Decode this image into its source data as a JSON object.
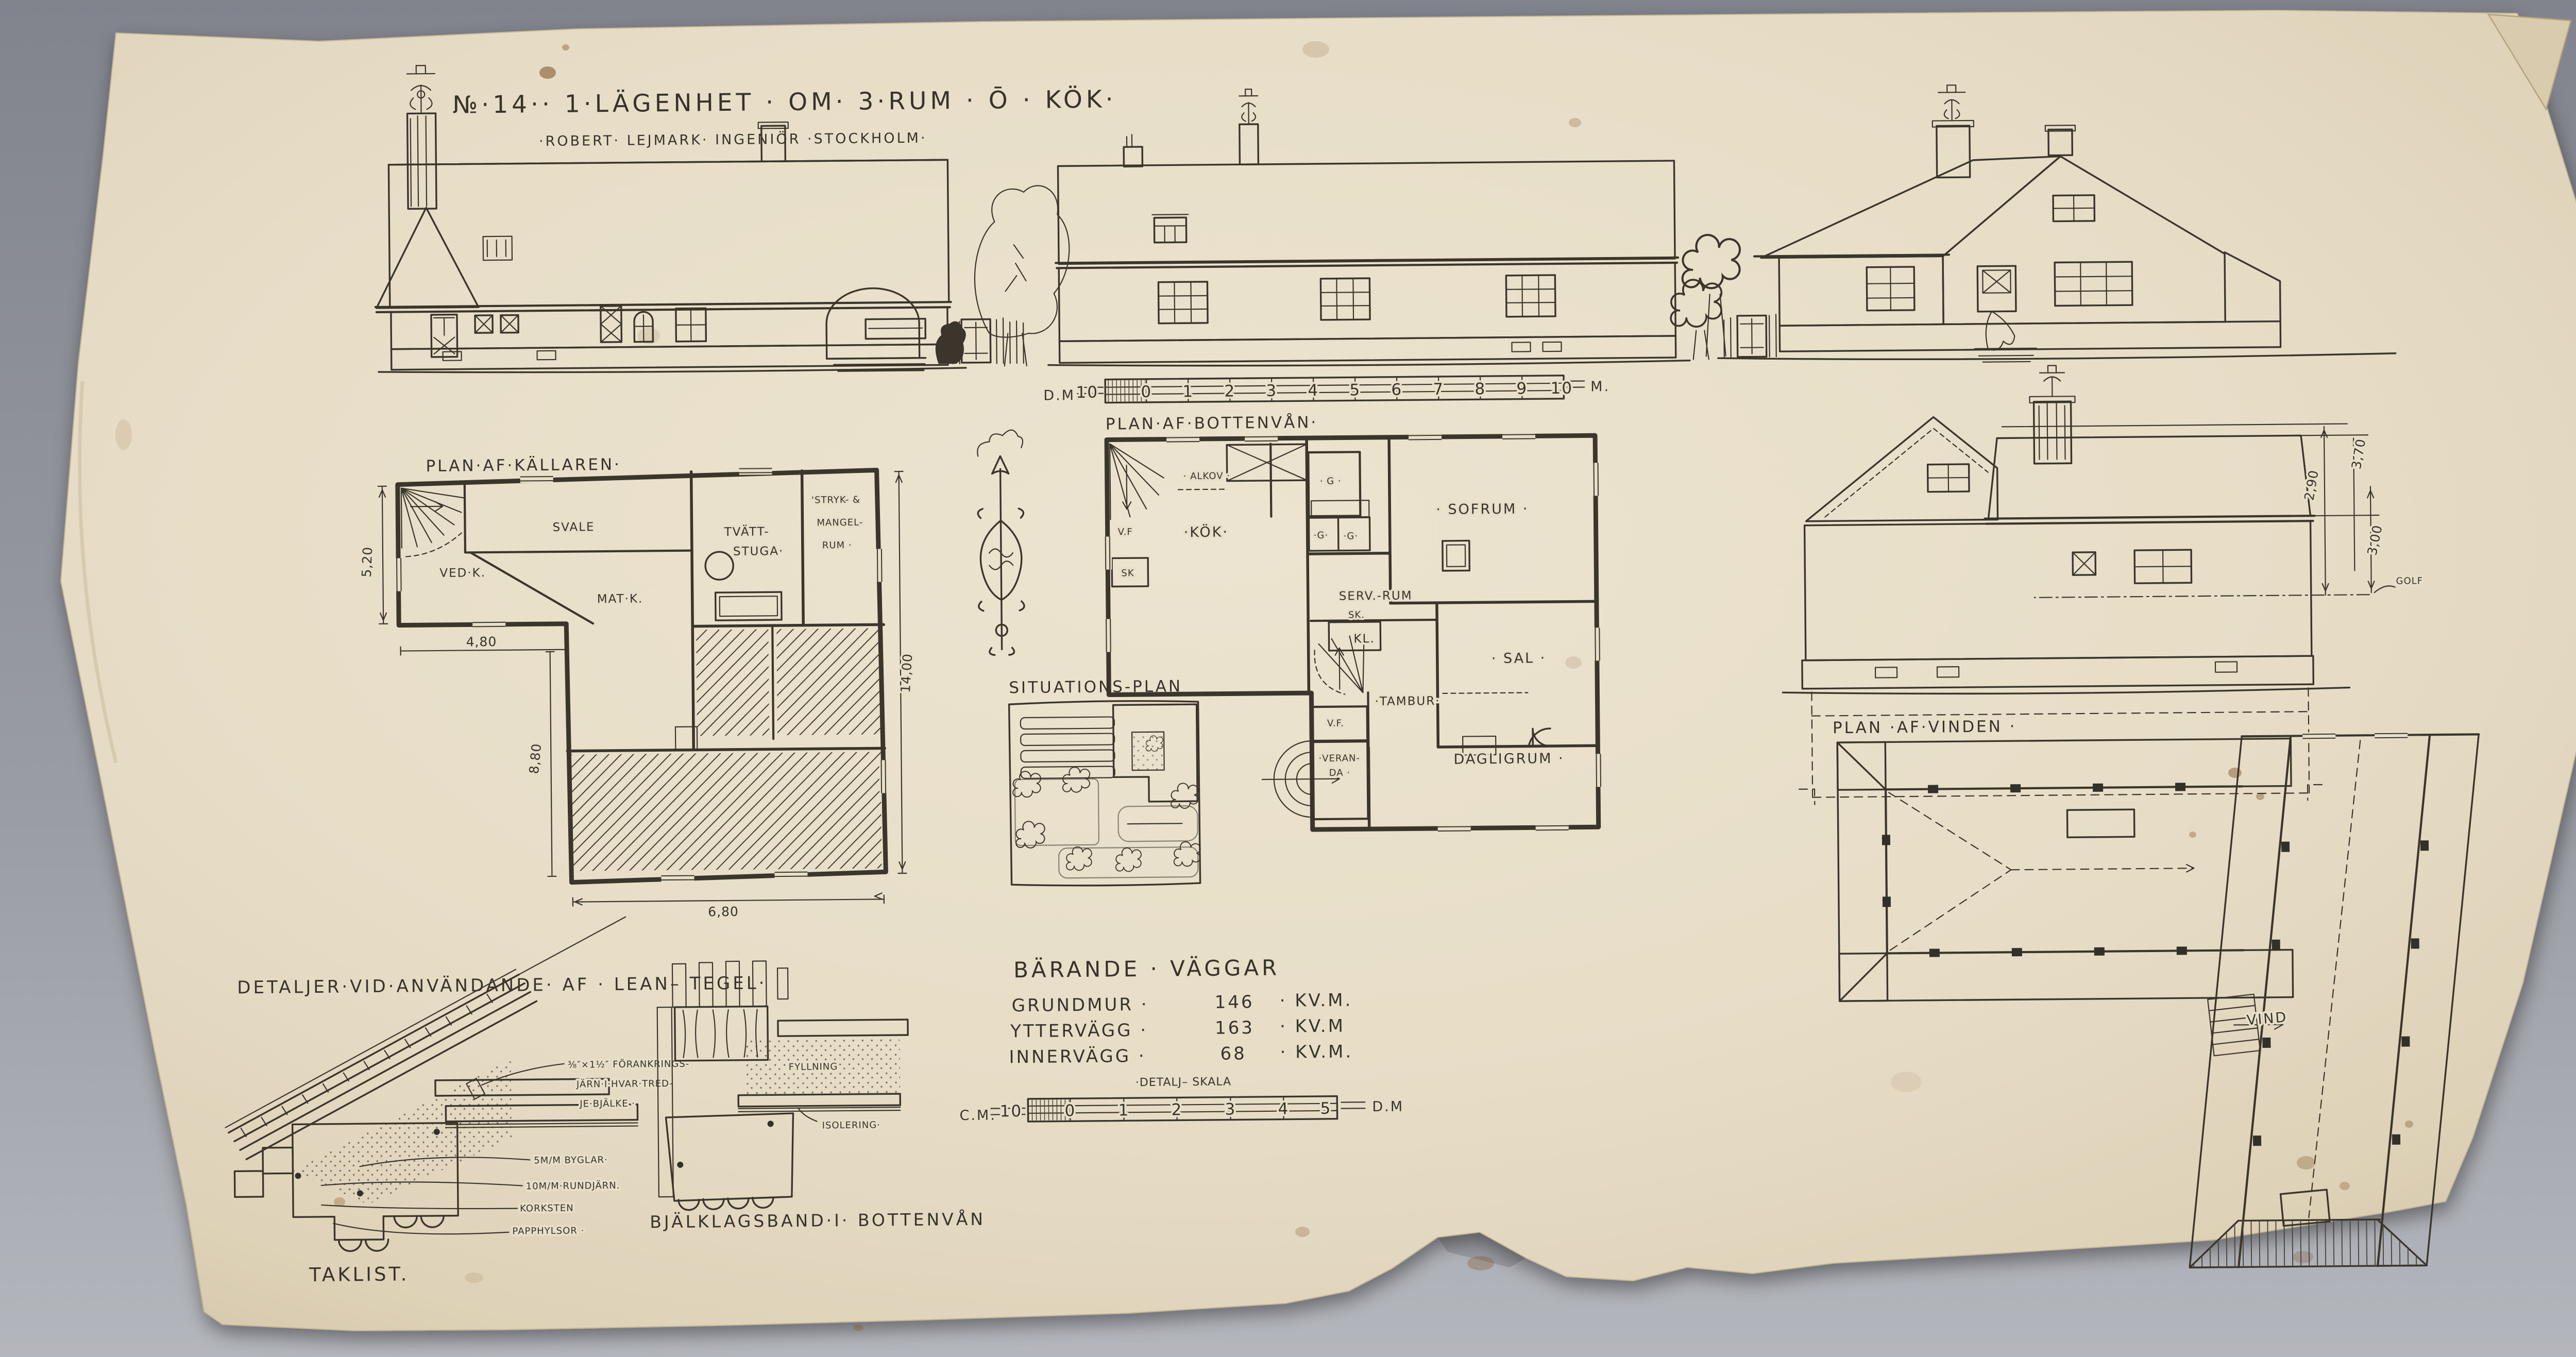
{
  "photo": {
    "background_top": "#83868e",
    "background_bottom": "#b2b4bb",
    "paper_color": "#e8dfc9",
    "ink_color": "#3b352b"
  },
  "header": {
    "title": "№·14·· 1·LÄGENHET · OM· 3·RUM · Ō · KÖK·",
    "subtitle": "·ROBERT· LEJMARK· INGENIÖR ·STOCKHOLM·"
  },
  "main_scale": {
    "label_left": "D.M.",
    "label_right": "M.",
    "ticks": [
      "10",
      "0",
      "1",
      "2",
      "3",
      "4",
      "5",
      "6",
      "7",
      "8",
      "9",
      "10"
    ]
  },
  "basement": {
    "title": "PLAN·AF·KÄLLAREN·",
    "rooms": {
      "svale": "SVALE",
      "vedk": "VED·K.",
      "tvatt_1": "TVÄTT-",
      "tvatt_2": "STUGA·",
      "stryk_1": "'STRYK- &",
      "stryk_2": "MANGEL-",
      "stryk_3": "RUM ·",
      "matk": "MAT·K."
    },
    "dims": {
      "h_left": "5,20",
      "w_left": "4,80",
      "h_mid": "8,80",
      "w_bottom": "6,80",
      "h_right": "14,00"
    }
  },
  "ground": {
    "title": "PLAN·AF·BOTTENVÅN·",
    "rooms": {
      "vf_top": "V.F",
      "alkov": "· ALKOV ·",
      "kok": "·KÖK·",
      "g_top": "· G ·",
      "g_1": "·G·",
      "g_2": "·G·",
      "sk_1": "SK",
      "sofrum": "· SOFRUM ·",
      "servrum": "SERV.-RUM",
      "sk_2": "SK.",
      "kl": "KL.",
      "sal": "· SAL ·",
      "tambur": "·TAMBUR·",
      "vf_bottom": "V.F.",
      "veranda_1": "·VERAN-",
      "veranda_2": "DA ·",
      "dagligrum": "DAGLIGRUM ·"
    }
  },
  "situation": {
    "title": "SITUATIONS-PLAN"
  },
  "attic": {
    "title": "PLAN ·AF·VINDEN ·",
    "room": "VIND"
  },
  "section": {
    "dim_290": "2,90",
    "dim_370": "3,70",
    "dim_300": "3,00",
    "golf": "GOLF"
  },
  "details": {
    "title": "DETALJER·VID·ANVÄNDANDE· AF · LEAN– TEGEL·",
    "taklist_caption": "TAKLIST.",
    "bjalklag_caption": "BJÄLKLAGSBAND·I· BOTTENVÅN",
    "ann_1": "⅜″×1½″ FÖRANKRINGS-",
    "ann_2": "JÄRN·I·HVAR·TRED-",
    "ann_3": "JE·BJÄLKE ·",
    "ann_4": "5M/M BYGLAR·",
    "ann_5": "10M/M·RUNDJÄRN.",
    "ann_6": "KORKSTEN",
    "ann_7": "PAPPHYLSOR ·",
    "fyllning": "FYLLNING",
    "isolering": "ISOLERING·"
  },
  "areas": {
    "heading": "BÄRANDE · VÄGGAR",
    "rows": [
      {
        "label": "GRUNDMUR ·",
        "value": "146",
        "unit": "· KV.M."
      },
      {
        "label": "YTTERVÄGG ·",
        "value": "163",
        "unit": "· KV.M"
      },
      {
        "label": "INNERVÄGG ·",
        "value": "68",
        "unit": "· KV.M."
      }
    ],
    "detail_scale_title": "·DETALJ– SKALA",
    "detail_scale_left": "C.M.",
    "detail_scale_right": "D.M",
    "detail_ticks": [
      "10",
      "0",
      "1",
      "2",
      "3",
      "4",
      "5"
    ]
  }
}
